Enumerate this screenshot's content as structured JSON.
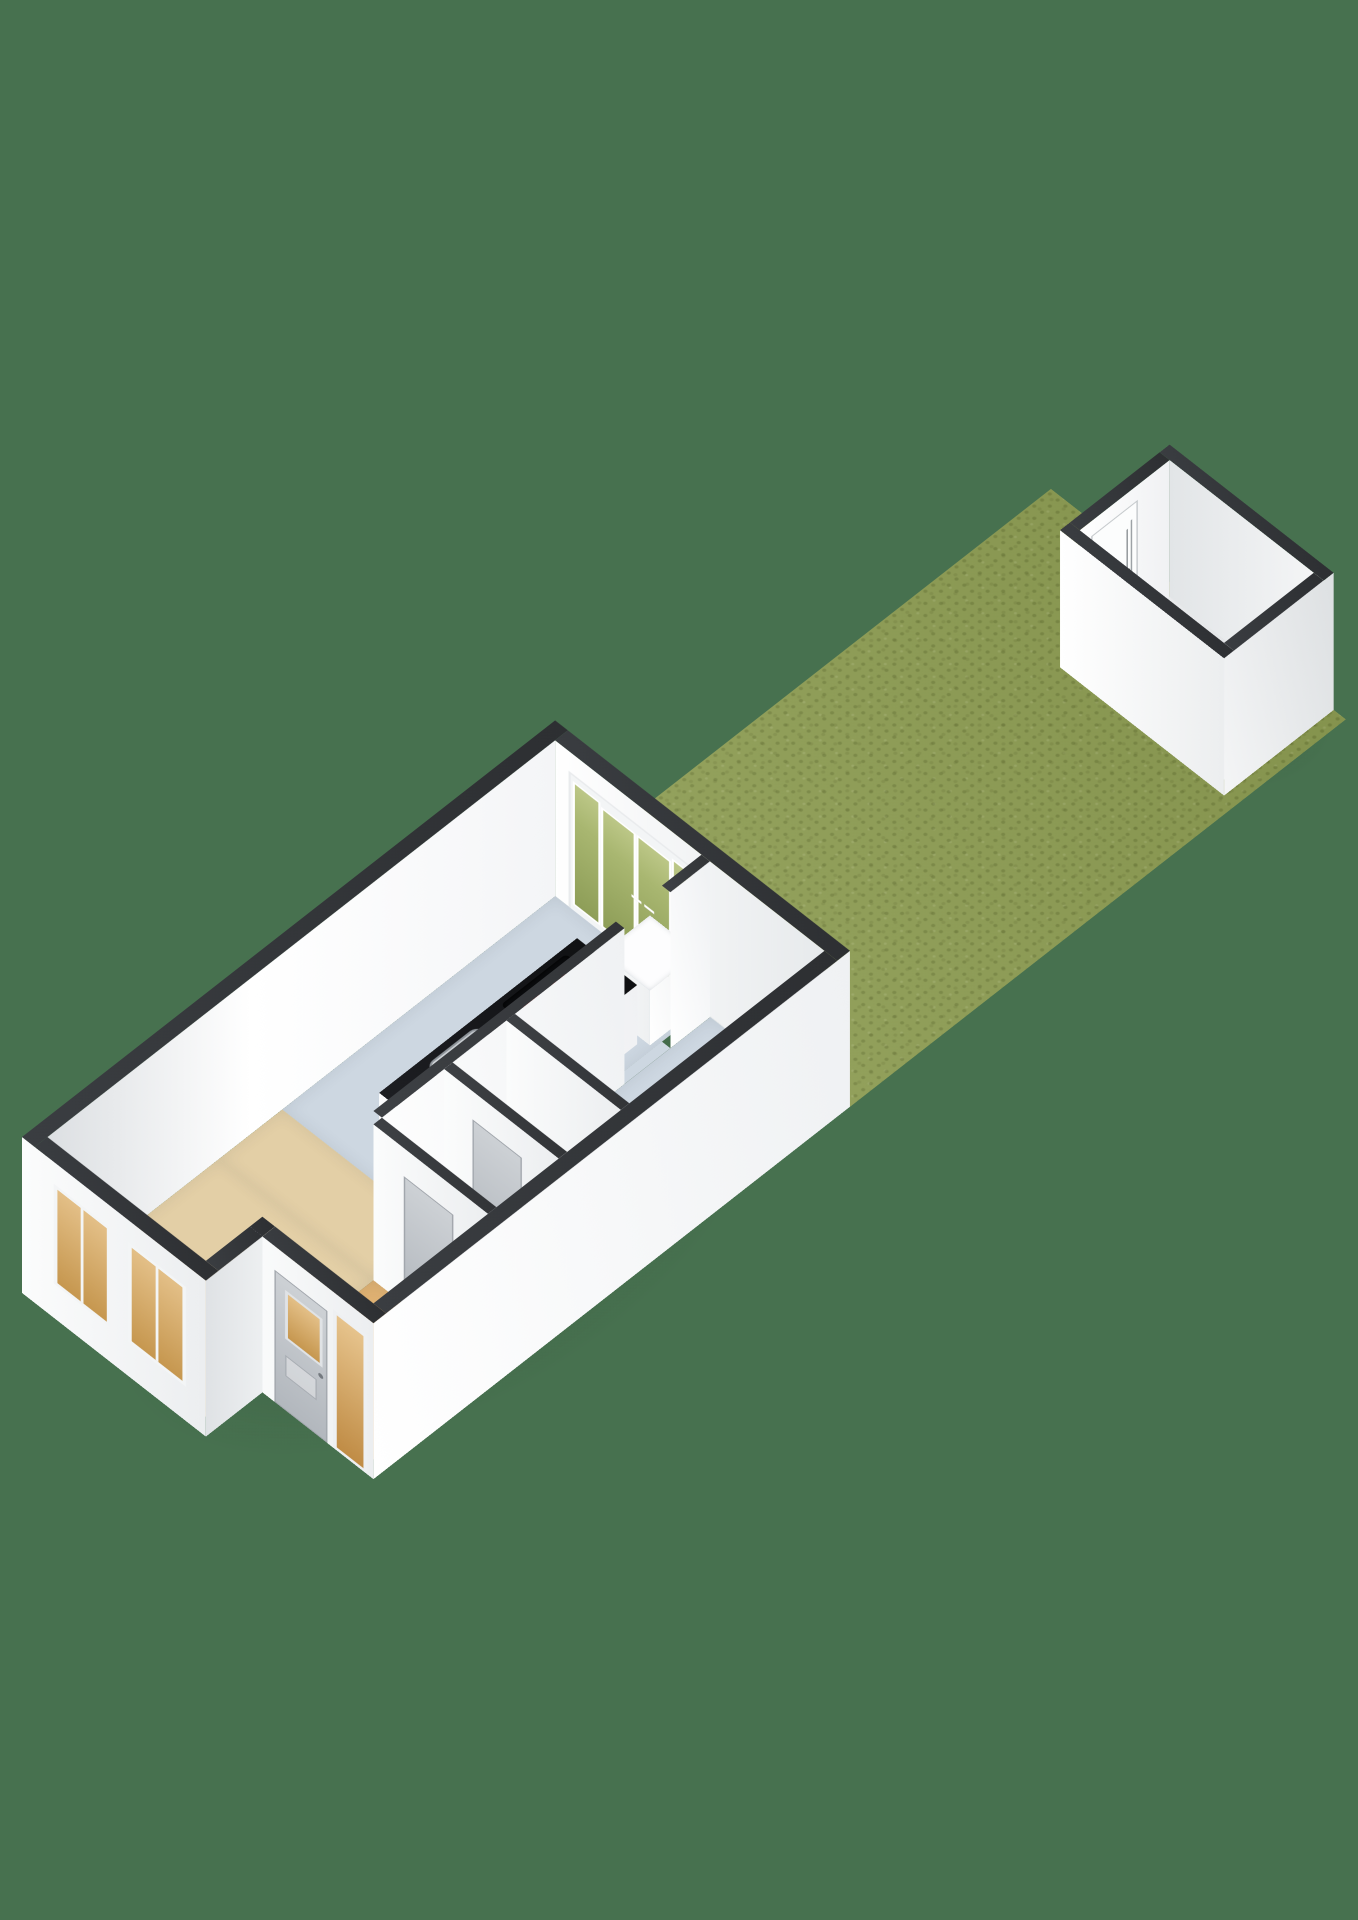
{
  "scene": {
    "type": "3d-floorplan-render",
    "view": "isometric-top-down",
    "text_content": "none (image contains no visible text)"
  },
  "colors": {
    "background": "#47714f",
    "grass": "#8f9e55",
    "wall_cap": "#333639",
    "wall_white": "#ffffff",
    "floor_living": "#e3cfa6",
    "floor_kitchen": "#cdd7e1",
    "floor_hall": "#dfb172",
    "floor_small_room": "#eceeef",
    "floor_wc": "#f4f5f6",
    "floor_shed": "#e9ebec",
    "island_top": "#16171a",
    "cooktop": "#0a0b0d",
    "burner_red": "#c92e23",
    "sink_steel": "#b9bec4",
    "door_gray": "#bcc1c6",
    "glass_warm": "#dcae72",
    "glass_green": "#9aa962"
  },
  "plot": {
    "structures": [
      {
        "name": "main-house",
        "shape": "rectangular with recessed entrance notch",
        "rooms": [
          {
            "name": "living-room",
            "floor": "beige",
            "windows": 2
          },
          {
            "name": "kitchen",
            "floor": "light-blue-gray",
            "fixtures": [
              "kitchen-island-black-top",
              "cooktop-4-red-burners",
              "stainless-sink-with-faucet",
              "white-end-counter"
            ]
          },
          {
            "name": "hallway",
            "floor": "orange-tan",
            "fixtures": [
              "front-door-with-window",
              "sidelight-window"
            ]
          },
          {
            "name": "storage-room",
            "floor": "light-gray",
            "fixtures": [
              "interior-door"
            ]
          },
          {
            "name": "wc",
            "floor": "white",
            "fixtures": [
              "toilet",
              "interior-door"
            ]
          },
          {
            "name": "bathroom",
            "floor": "light-blue-gray",
            "fixtures": [
              "shower-step-two-tier"
            ]
          }
        ],
        "openings": [
          "french-doors-to-garden-4-panes"
        ]
      },
      {
        "name": "garden",
        "surface": "grass-lawn-strip"
      },
      {
        "name": "shed",
        "features": [
          "open-top",
          "white-walls",
          "dark-rim",
          "interior-door-on-garden-side"
        ],
        "position": "far-end-of-garden"
      }
    ],
    "burner_count": 4,
    "french_door_pane_count": 4
  }
}
